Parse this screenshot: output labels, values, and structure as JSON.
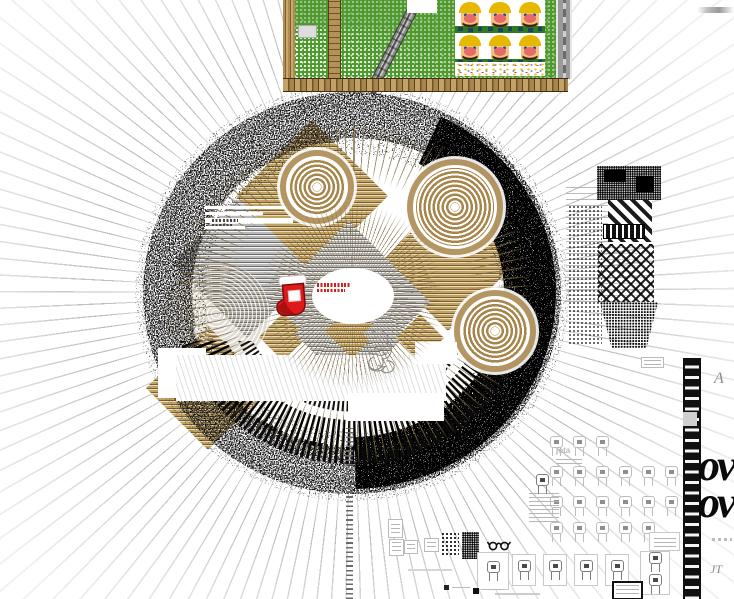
{
  "artwork": {
    "type_label": "glitch-collage",
    "glyphs": {
      "line1": "ov",
      "line2": "ov"
    },
    "labels": {
      "a": "A",
      "jt": "JT",
      "jota": "jota"
    },
    "sprite_sheet": {
      "character": "wario-face",
      "rows": 2,
      "cols": 3
    },
    "robot_grid_rows": [
      3,
      6,
      6,
      5
    ],
    "card_count": 6,
    "colors": {
      "grass_green": "#4f992f",
      "brick_tan": "#b2905a",
      "diamond_tan": "#ab8a50",
      "stocking_red": "#de1a1a",
      "ink_black": "#111111",
      "ray_gray": "#c6c6c6"
    }
  }
}
